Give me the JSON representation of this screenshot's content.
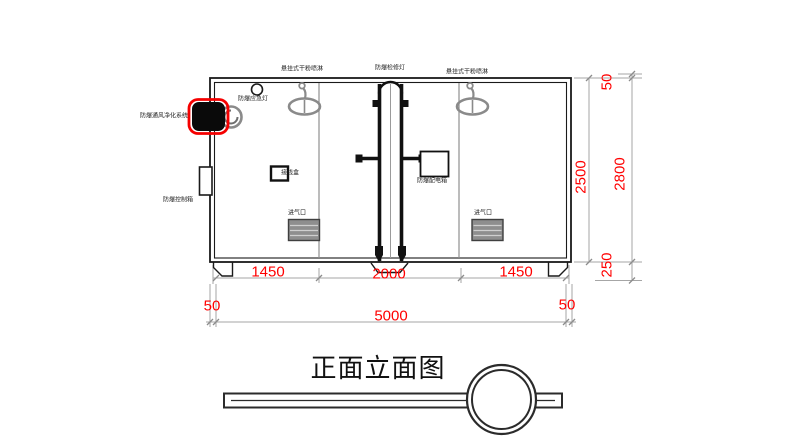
{
  "drawing": {
    "title": "正面立面图",
    "equipment_labels": {
      "sprinkler_left": "悬挂式干粉喷淋",
      "inspection_light": "防爆检修灯",
      "sprinkler_right": "悬挂式干粉喷淋",
      "emergency_light": "防爆应急灯",
      "ventilation_system": "防爆通风净化系统",
      "control_box": "防爆控制箱",
      "junction_box": "接线盒",
      "distribution_box": "防爆配电箱",
      "air_inlet_left": "进气口",
      "air_inlet_right": "进气口"
    },
    "dimensions": {
      "seg_left": "1450",
      "seg_center": "2000",
      "seg_right": "1450",
      "wall_left": "50",
      "total_width": "5000",
      "wall_right": "50",
      "inner_height": "2500",
      "roof": "50",
      "total_height": "2800",
      "base": "250"
    },
    "colors": {
      "dimension_text": "#ff0000",
      "highlight_outline": "#ff0000",
      "main_line": "#1a1a1a",
      "secondary_line": "#9a9a9a"
    }
  }
}
